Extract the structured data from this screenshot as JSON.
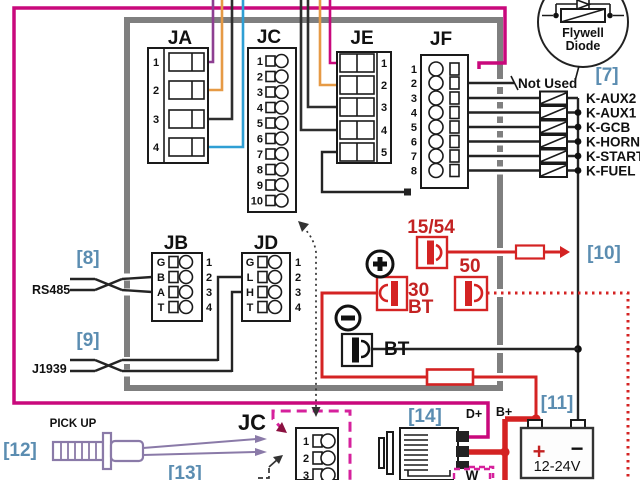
{
  "connectors": {
    "ja": {
      "label": "JA",
      "pins": [
        "1",
        "2",
        "3",
        "4"
      ]
    },
    "jb": {
      "label": "JB",
      "letters": [
        "G",
        "B",
        "A",
        "T"
      ],
      "pins": [
        "1",
        "2",
        "3",
        "4"
      ]
    },
    "jc_top": {
      "label": "JC",
      "pins": [
        "1",
        "2",
        "3",
        "4",
        "5",
        "6",
        "7",
        "8",
        "9",
        "10"
      ]
    },
    "jd": {
      "label": "JD",
      "letters": [
        "G",
        "L",
        "H",
        "T"
      ],
      "pins": [
        "1",
        "2",
        "3",
        "4"
      ]
    },
    "je": {
      "label": "JE",
      "pins": [
        "1",
        "2",
        "3",
        "4",
        "5"
      ]
    },
    "jf": {
      "label": "JF",
      "pins": [
        "1",
        "2",
        "3",
        "4",
        "5",
        "6",
        "7",
        "8"
      ]
    },
    "jc_bottom": {
      "label": "JC",
      "pins": [
        "1",
        "2",
        "3"
      ]
    }
  },
  "relay_outputs": {
    "not_used": "Not Used",
    "labels": [
      "K-AUX2",
      "K-AUX1",
      "K-GCB",
      "K-HORN",
      "K-START",
      "K-FUEL"
    ]
  },
  "flywell_diode": {
    "line1": "Flywell",
    "line2": "Diode"
  },
  "callout_refs": {
    "r7": "[7]",
    "r8": "[8]",
    "r9": "[9]",
    "r10": "[10]",
    "r11": "[11]",
    "r12": "[12]",
    "r13": "[13]",
    "r14": "[14]"
  },
  "power": {
    "key_1554": "15/54",
    "key_50": "50",
    "batt_30": "30",
    "batt_30_bt": "BT",
    "bt_neg": "BT",
    "battery_plus": "+",
    "battery_minus": "−",
    "battery_voltage": "12-24V",
    "b_plus": "B+",
    "d_plus": "D+",
    "w": "W"
  },
  "comm_ports": {
    "rs485": "RS485",
    "j1939": "J1939"
  },
  "pickup": {
    "label": "PICK UP"
  },
  "colors": {
    "magenta": "#c9087c",
    "dashed_magenta": "#d6219c",
    "purple": "#8e3f92",
    "orange": "#e69a45",
    "blue_wire": "#2f9fd4",
    "red": "#d42323",
    "callout_blue": "#5b8db1",
    "border_gray": "#7f7f7f"
  }
}
